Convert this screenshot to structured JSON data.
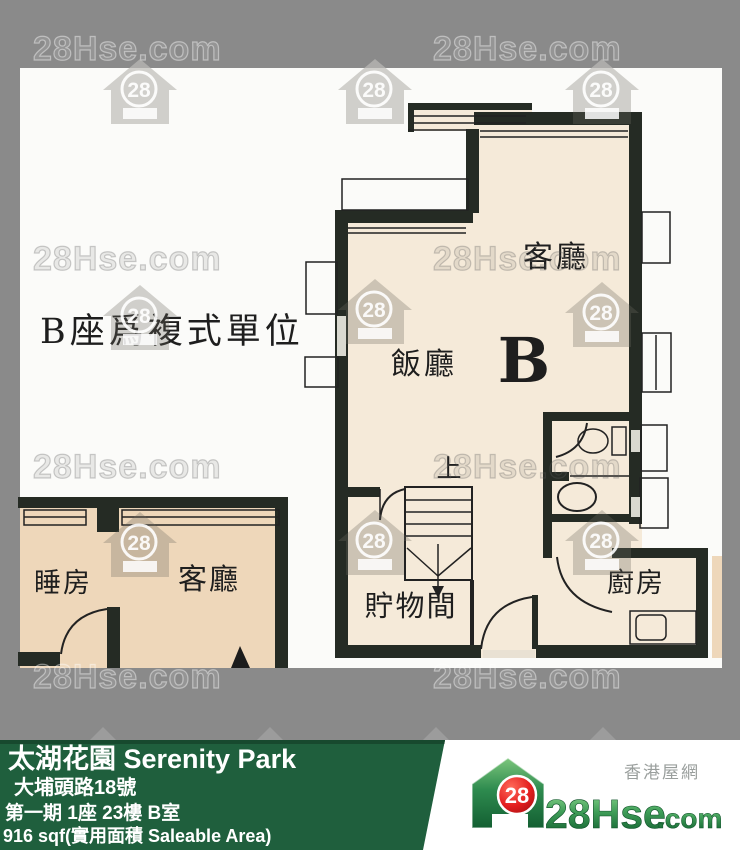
{
  "watermark": {
    "text": "28Hse.com",
    "badge": "28"
  },
  "floor_plan": {
    "note": "B座爲複式單位",
    "unit_label": "B",
    "rooms": {
      "living_upper": "客廳",
      "dining": "飯廳",
      "stairs_up": "上",
      "storage": "貯物間",
      "kitchen": "廚房",
      "bedroom": "睡房",
      "living_lower": "客廳"
    }
  },
  "info_bar": {
    "title": "太湖花園 Serenity Park",
    "address": "大埔頭路18號",
    "unit": "第一期 1座 23樓 B室",
    "area": "916 sqf(實用面積 Saleable Area)"
  },
  "logo": {
    "badge": "28",
    "brand_main": "28Hse",
    "brand_suffix": ".com",
    "tagline": "香港屋網"
  },
  "colors": {
    "accent_green": "#1f5f3d",
    "accent_green_dark": "#17492e",
    "logo_red": "#e31e1e",
    "floor_upper": "#f5ead9",
    "floor_lower": "#eed7ba",
    "wall": "#252b24",
    "border_gray": "#8a8a8a"
  }
}
